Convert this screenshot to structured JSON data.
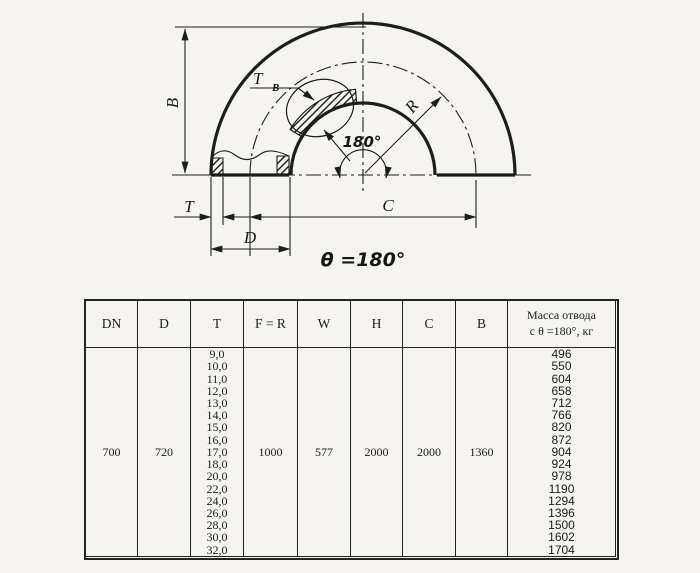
{
  "drawing": {
    "labels": {
      "b": "B",
      "t": "T",
      "tb_main": "T",
      "tb_sub": "B",
      "r": "R",
      "angle": "180°",
      "c": "C",
      "d": "D"
    },
    "caption": "θ =180°"
  },
  "table": {
    "headers": [
      "DN",
      "D",
      "T",
      "F = R",
      "W",
      "H",
      "C",
      "B"
    ],
    "mass_header_line1": "Масса отвода",
    "mass_header_line2": "с θ =180°, кг",
    "row": {
      "dn": "700",
      "d": "720",
      "t_values": [
        "9,0",
        "10,0",
        "11,0",
        "12,0",
        "13,0",
        "14,0",
        "15,0",
        "16,0",
        "17,0",
        "18,0",
        "20,0",
        "22,0",
        "24,0",
        "26,0",
        "28,0",
        "30,0",
        "32,0"
      ],
      "f_r": "1000",
      "w": "577",
      "h": "2000",
      "c": "2000",
      "b": "1360",
      "mass_values": [
        "496",
        "550",
        "604",
        "658",
        "712",
        "766",
        "820",
        "872",
        "904",
        "924",
        "978",
        "1190",
        "1294",
        "1396",
        "1500",
        "1602",
        "1704"
      ]
    }
  }
}
